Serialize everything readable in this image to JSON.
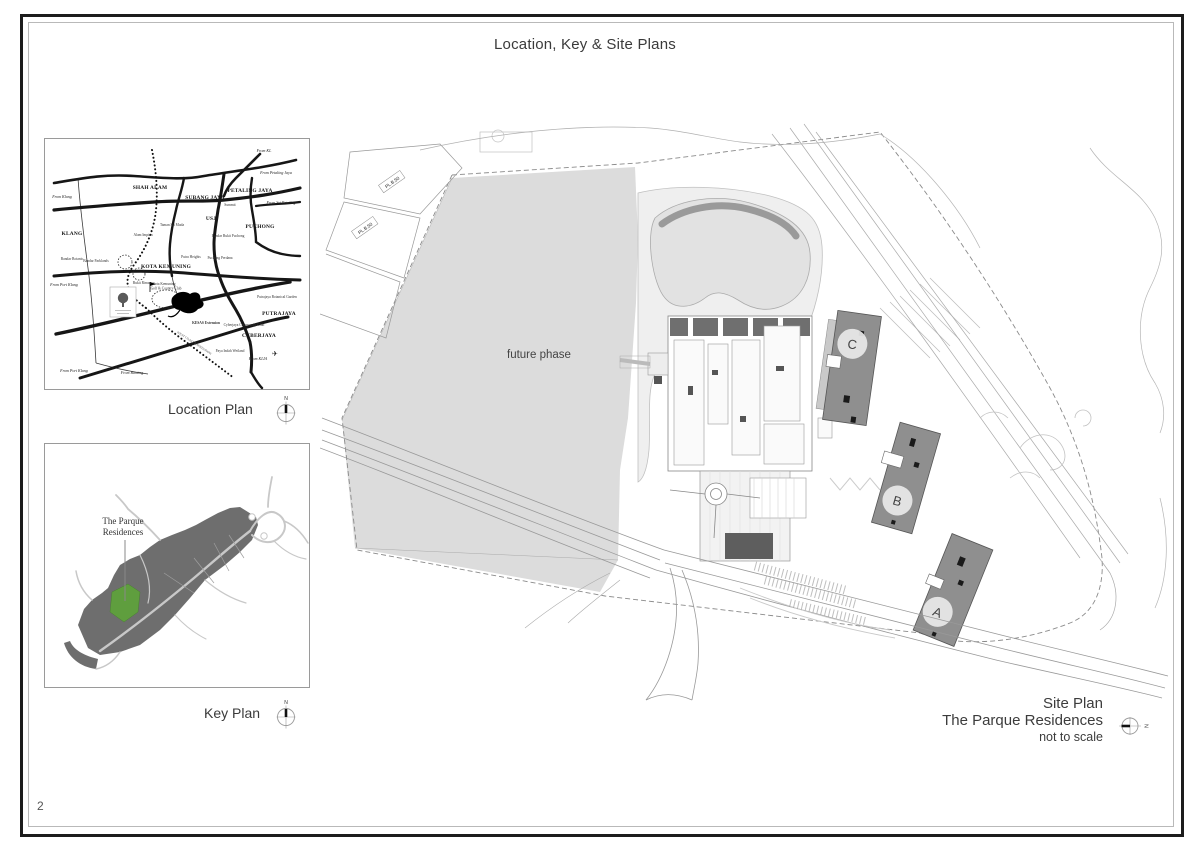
{
  "page": {
    "title": "Location, Key & Site Plans",
    "number": "2"
  },
  "location_plan": {
    "caption": "Location Plan",
    "compass_north": "N",
    "regions": [
      "SHAH ALAM",
      "SUBANG JAYA",
      "PETALING JAYA",
      "KLANG",
      "USJ",
      "PUCHONG",
      "KOTA KEMUNING",
      "PUTRAJAYA",
      "CYBERJAYA"
    ],
    "route_labels": [
      "From KL",
      "From Petaling Jaya",
      "From Sri Petaling",
      "From Klang",
      "From Port Klang",
      "From Port Klang",
      "From Banting",
      "From KLIA"
    ],
    "places": [
      "Taman Sri Muda",
      "Alam Impian",
      "Bukit Rimau",
      "Putra Heights",
      "Puchong Perdana",
      "Summit",
      "Bandar Bukit Puchong",
      "Putrajaya Botanical Garden",
      "Cyberjaya Community Club",
      "Paya Indah Wetland",
      "KESAS Extension",
      "Kota Kemuning",
      "Golf & Country Club",
      "Bandar Botanic",
      "Bandar Parklands",
      "WEST COAST EXPRESSWAY"
    ],
    "airplane_icon": "✈"
  },
  "key_plan": {
    "caption": "Key Plan",
    "compass_north": "N",
    "site_label_line1": "The Parque",
    "site_label_line2": "Residences"
  },
  "site_plan": {
    "future_phase_label": "future phase",
    "parcel_label_1": "PL.B.50",
    "parcel_label_2": "PL.B.50",
    "tower_a": "A",
    "tower_b": "B",
    "tower_c": "C",
    "caption_line1": "Site Plan",
    "caption_line2": "The Parque Residences",
    "caption_line3": "not to scale",
    "compass_north": "N"
  },
  "colors": {
    "future_phase_fill": "#dcdcdc",
    "tower_fill": "#8f8f8f",
    "keyplan_land": "#6e6e6e",
    "keyplan_site_green": "#5f9e3e",
    "drawing_line": "#9a9a9a",
    "road_black": "#161616"
  }
}
